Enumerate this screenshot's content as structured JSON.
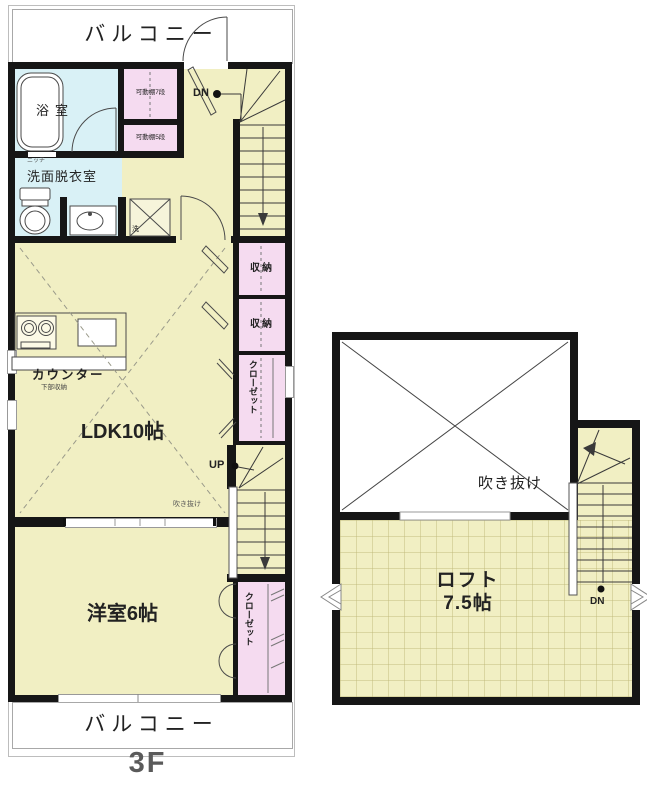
{
  "floor_plan": {
    "floor_label": "3F",
    "colors": {
      "wall": "#161616",
      "room": "#f1efc3",
      "storage": "#f5dbf0",
      "bath": "#d9f1f6",
      "line": "#4a4a4a"
    },
    "main_unit": {
      "balcony_top": "バルコニー",
      "balcony_bottom": "バルコニー",
      "bathroom": "浴室",
      "niche": "ニッチ",
      "washroom": "洗面脱衣室",
      "washer_mark": "洗",
      "shelf_7": "可動棚7段",
      "shelf_5": "可動棚5段",
      "stairs_down": "DN",
      "stairs_up": "UP",
      "storage_1": "収納",
      "storage_2": "収納",
      "closet_mid": "クローゼット",
      "closet_bottom": "クローゼット",
      "counter": "カウンター",
      "counter_note": "下部収納",
      "ldk": "LDK10帖",
      "void_note": "吹き抜け",
      "bedroom": "洋室6帖"
    },
    "loft_unit": {
      "void": "吹き抜け",
      "loft_name": "ロフト",
      "loft_size": "7.5帖",
      "stairs_down": "DN"
    }
  }
}
